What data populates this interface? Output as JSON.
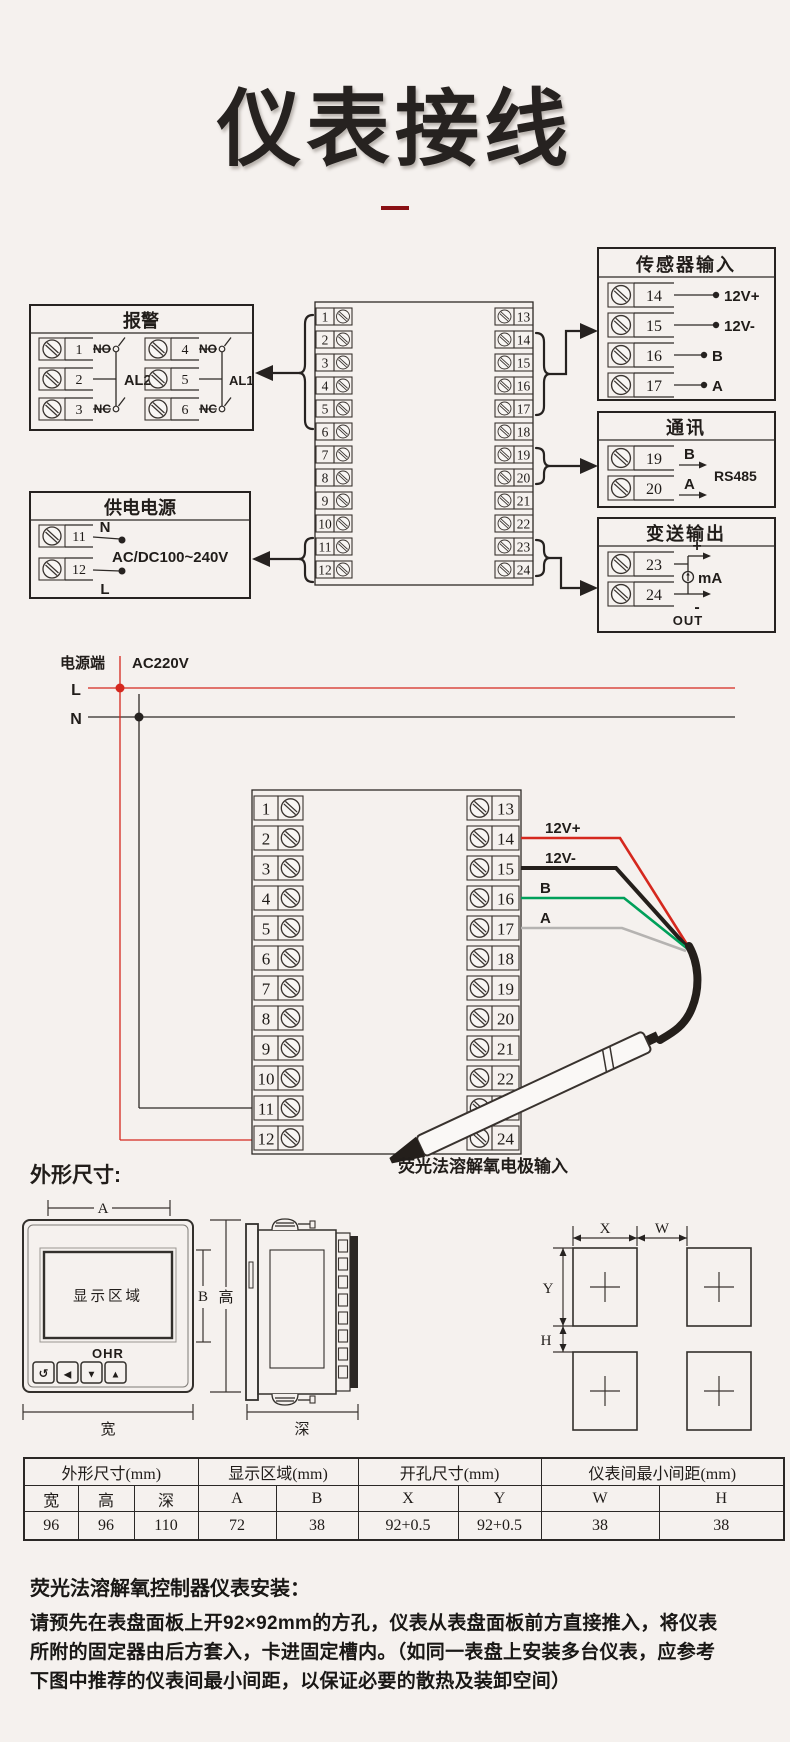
{
  "page": {
    "title": "仪表接线"
  },
  "terminals": [
    "1",
    "2",
    "3",
    "4",
    "5",
    "6",
    "7",
    "8",
    "9",
    "10",
    "11",
    "12",
    "13",
    "14",
    "15",
    "16",
    "17",
    "18",
    "19",
    "20",
    "21",
    "22",
    "23",
    "24"
  ],
  "d1": {
    "alarm": {
      "title": "报警",
      "no": "NO",
      "nc": "NC",
      "al2": "AL2",
      "al1": "AL1",
      "t1": "1",
      "t2": "2",
      "t3": "3",
      "t4": "4",
      "t5": "5",
      "t6": "6"
    },
    "supply": {
      "title": "供电电源",
      "t11": "11",
      "t12": "12",
      "n": "N",
      "l": "L",
      "range": "AC/DC100~240V"
    },
    "sensor": {
      "title": "传感器输入",
      "t14": "14",
      "t15": "15",
      "t16": "16",
      "t17": "17",
      "r14": "12V+",
      "r15": "12V-",
      "r16": "B",
      "r17": "A"
    },
    "comm": {
      "title": "通讯",
      "t19": "19",
      "t20": "20",
      "b": "B",
      "a": "A",
      "protocol": "RS485"
    },
    "out": {
      "title": "变送输出",
      "t23": "23",
      "t24": "24",
      "plus": "+",
      "minus": "-",
      "unit": "mA",
      "label": "OUT"
    }
  },
  "d2": {
    "source": "电源端",
    "voltage": "AC220V",
    "live": "L",
    "neutral": "N",
    "w14": "12V+",
    "w15": "12V-",
    "w16": "B",
    "w17": "A",
    "wire_colors": {
      "v12p": "#d5281e",
      "v12m": "#241f1b",
      "b": "#00a05a",
      "a": "#b5b3b1"
    },
    "electrode": "荧光法溶解氧电极输入"
  },
  "dims": {
    "heading": "外形尺寸:",
    "display": "显示区域",
    "brand": "OHR",
    "btn_back": "↺",
    "btn_left": "◀",
    "btn_down": "▼",
    "btn_up": "▲",
    "a": "A",
    "b": "B",
    "h_label": "高",
    "w_label": "宽",
    "depth": "深",
    "x": "X",
    "w": "W",
    "y": "Y",
    "h": "H"
  },
  "spec": {
    "g1": "外形尺寸(mm)",
    "g2": "显示区域(mm)",
    "g3": "开孔尺寸(mm)",
    "g4": "仪表间最小间距(mm)",
    "c1": "宽",
    "c2": "高",
    "c3": "深",
    "c4": "A",
    "c5": "B",
    "c6": "X",
    "c7": "Y",
    "c8": "W",
    "c9": "H",
    "v1": "96",
    "v2": "96",
    "v3": "110",
    "v4": "72",
    "v5": "38",
    "v6": "92+0.5",
    "v7": "92+0.5",
    "v8": "38",
    "v9": "38"
  },
  "install": {
    "heading": "荧光法溶解氧控制器仪表安装：",
    "line1": "请预先在表盘面板上开92×92mm的方孔，仪表从表盘面板前方直接推入，将仪表",
    "line2": "所附的固定器由后方套入，卡进固定槽内。（如同一表盘上安装多台仪表，应参考",
    "line3": "下图中推荐的仪表间最小间距，以保证必要的散热及装卸空间）"
  }
}
